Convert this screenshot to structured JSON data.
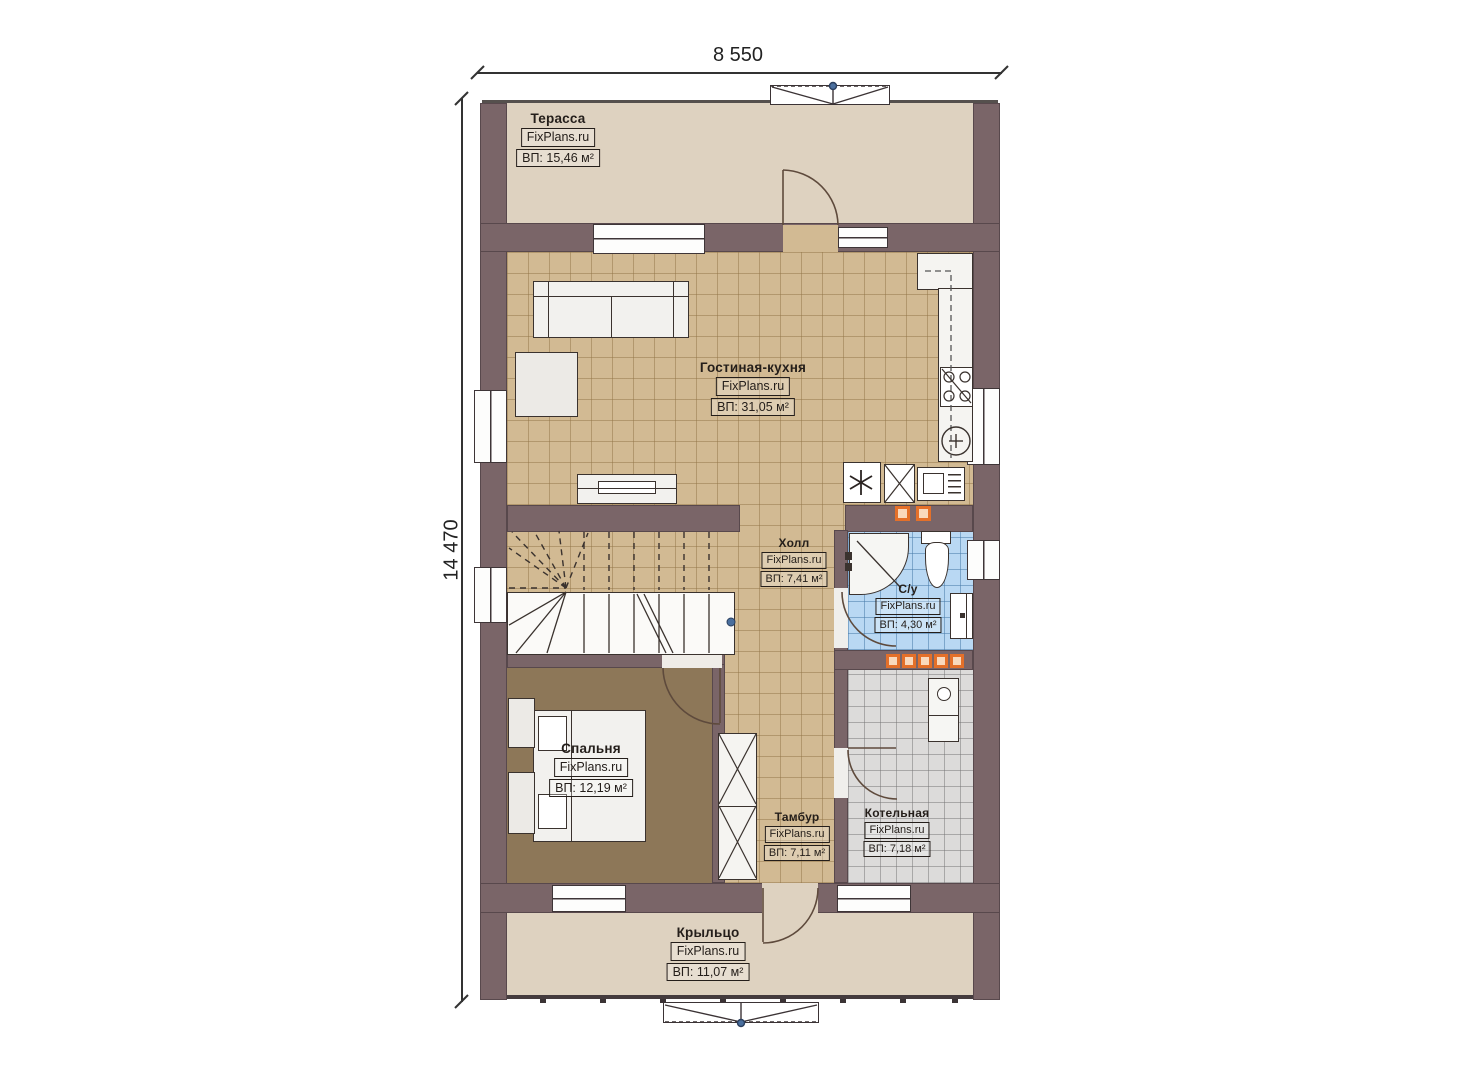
{
  "plan": {
    "width_dim": "8 550",
    "height_dim": "14 470",
    "brand": "FixPlans.ru",
    "rooms": [
      {
        "key": "terrace",
        "name": "Терасса",
        "brand": "FixPlans.ru",
        "area": "ВП: 15,46 м²"
      },
      {
        "key": "living",
        "name": "Гостиная-кухня",
        "brand": "FixPlans.ru",
        "area": "ВП: 31,05 м²"
      },
      {
        "key": "hall",
        "name": "Холл",
        "brand": "FixPlans.ru",
        "area": "ВП: 7,41 м²"
      },
      {
        "key": "bathroom",
        "name": "С/у",
        "brand": "FixPlans.ru",
        "area": "ВП: 4,30 м²"
      },
      {
        "key": "bedroom",
        "name": "Спальня",
        "brand": "FixPlans.ru",
        "area": "ВП: 12,19 м²"
      },
      {
        "key": "vestibule",
        "name": "Тамбур",
        "brand": "FixPlans.ru",
        "area": "ВП: 7,11 м²"
      },
      {
        "key": "boiler",
        "name": "Котельная",
        "brand": "FixPlans.ru",
        "area": "ВП: 7,18 м²"
      },
      {
        "key": "porch",
        "name": "Крыльцо",
        "brand": "FixPlans.ru",
        "area": "ВП: 11,07 м²"
      }
    ],
    "colors": {
      "wall": "#7a6568",
      "tile_tan": "#d2ba93",
      "tile_blue": "#b9d8f3",
      "tile_gray": "#dcdbda",
      "bedroom_floor": "#8d7758",
      "terrace_floor": "#ded2c0",
      "radiator_orange": "#e4702a",
      "marker_blue": "#4a6f9e"
    }
  }
}
